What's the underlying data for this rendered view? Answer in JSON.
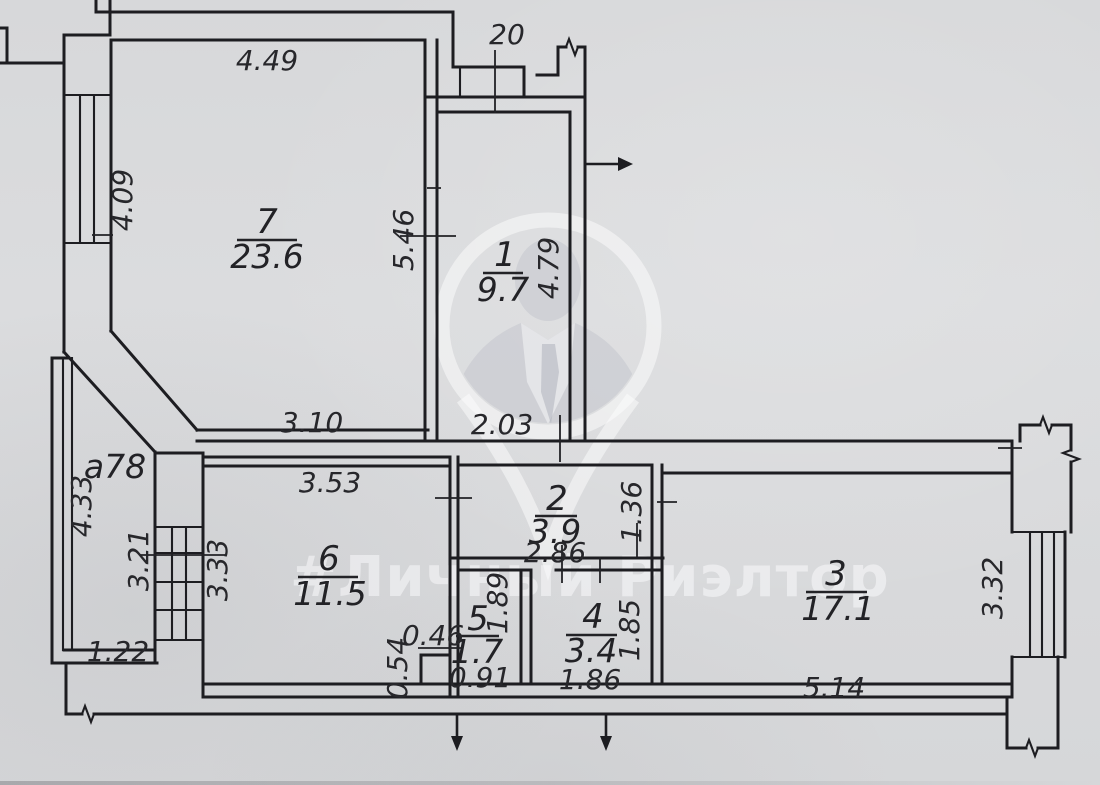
{
  "watermark": {
    "text": "#Личный Риэлтор"
  },
  "plan": {
    "balcony_top": {
      "label": "20"
    },
    "loggia": {
      "label": "a78",
      "dim_left": "4.33",
      "dim_window": "3.21",
      "dim_bottom": "1.22"
    },
    "rooms": [
      {
        "number": "7",
        "area": "23.6",
        "dim_top": "4.49",
        "dim_left": "4.09",
        "dim_right": "5.46",
        "dim_bottom": "3.10"
      },
      {
        "number": "1",
        "area": "9.7",
        "dim_right": "4.79",
        "dim_bottom": "2.03"
      },
      {
        "number": "2",
        "area": "3.9",
        "dim_bottom": "2.86",
        "dim_right": "1.36"
      },
      {
        "number": "6",
        "area": "11.5",
        "dim_top": "3.53",
        "dim_left": "3.33"
      },
      {
        "number": "5",
        "area": "1.7",
        "dim_bottom": "0.91",
        "dim_right": "1.89",
        "dim_step_w": "0.46",
        "dim_step_h": "0.54"
      },
      {
        "number": "4",
        "area": "3.4",
        "dim_bottom": "1.86",
        "dim_right": "1.85"
      },
      {
        "number": "3",
        "area": "17.1",
        "dim_bottom": "5.14",
        "dim_right": "3.32"
      }
    ]
  }
}
